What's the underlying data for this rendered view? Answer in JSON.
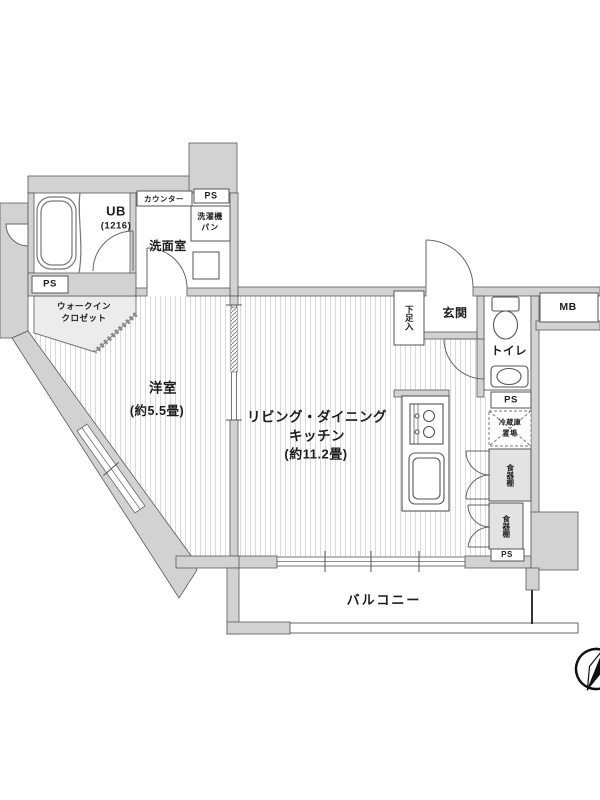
{
  "floorplan": {
    "rooms": {
      "unit_bath": {
        "name": "UB",
        "size": "(1216)"
      },
      "washroom": {
        "name": "洗面室"
      },
      "walk_in_closet": {
        "line1": "ウォークイン",
        "line2": "クロゼット"
      },
      "western_room": {
        "name": "洋室",
        "size": "(約5.5畳)"
      },
      "ldk": {
        "name1": "リビング・ダイニング",
        "name2": "キッチン",
        "size": "(約11.2畳)"
      },
      "entrance": {
        "name": "玄関"
      },
      "toilet": {
        "name": "トイレ"
      },
      "balcony": {
        "name": "バルコニー"
      }
    },
    "fixtures": {
      "counter": "カウンター",
      "washer_pan_line1": "洗濯機",
      "washer_pan_line2": "パン",
      "shoe_cabinet": "下足入",
      "fridge_space_line1": "冷蔵庫",
      "fridge_space_line2": "置場",
      "cupboard": "食器棚",
      "meter_box": "MB",
      "pipe_space": "PS"
    },
    "colors": {
      "wall_fill": "#d2d2d2",
      "wall_stroke": "#5a5a5a",
      "floor_hatch": "#d9d9d9",
      "cabinet_fill": "#e3e3e3",
      "text": "#1d1d1d"
    }
  }
}
